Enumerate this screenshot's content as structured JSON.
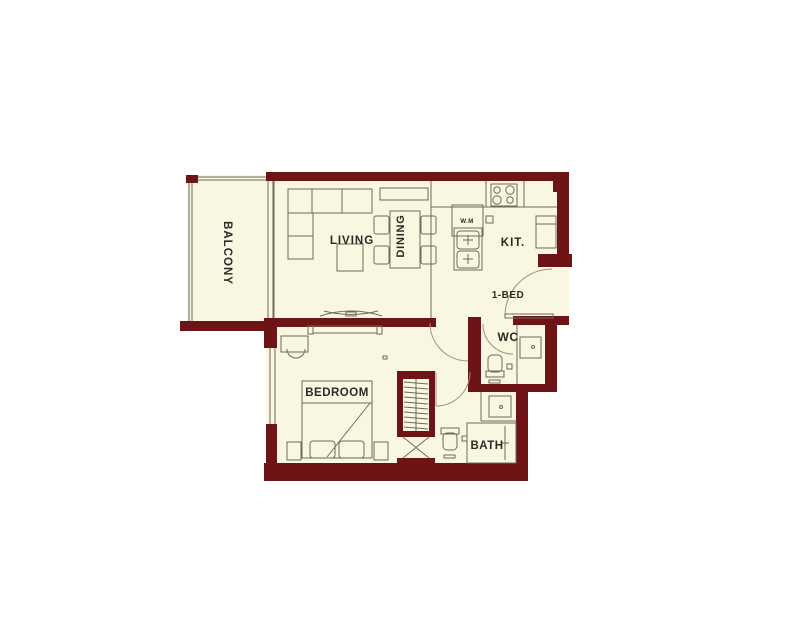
{
  "plan": {
    "colors": {
      "wall": "#6e1316",
      "floor": "#f9f6e2",
      "line": "#6f6b5c",
      "arc": "#989382",
      "text": "#2b2b26",
      "background": "#ffffff"
    },
    "rooms": {
      "balcony": {
        "label": "BALCONY"
      },
      "living": {
        "label": "LIVING"
      },
      "dining": {
        "label": "DINING"
      },
      "kitchen": {
        "label": "KIT."
      },
      "unit": {
        "label": "1-BED"
      },
      "wc": {
        "label": "WC"
      },
      "bedroom": {
        "label": "BEDROOM"
      },
      "bath": {
        "label": "BATH"
      },
      "washing_machine": {
        "label": "W.M"
      }
    }
  }
}
